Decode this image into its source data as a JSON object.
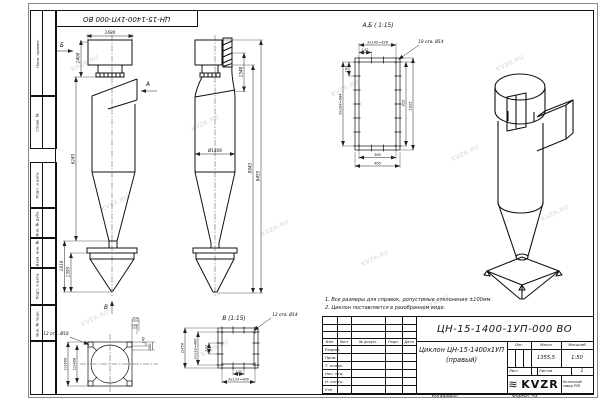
{
  "sheet": {
    "stamp_top": "ЦН-15-1400-1УП-000 ВО",
    "watermark": "KVZR.RU"
  },
  "margin": {
    "labels": [
      "Перв. примен.",
      "Справ. №",
      "Подп. и дата",
      "Инв. № дубл.",
      "Взам. инв. №",
      "Подп. и дата",
      "Инв. № подл."
    ]
  },
  "notes": {
    "line1": "1. Все размеры для справок, допустимые отклонения ±100мм.",
    "line2": "2. Циклон поставляется в разобранном виде."
  },
  "front_view": {
    "dim_top": "1680",
    "dim_height_outlet": "1400",
    "dim_body": "6245",
    "dim_bunker": "1810",
    "dim_bunker_cone": "1395",
    "arrow_a": "А",
    "arrow_b": "Б"
  },
  "side_view": {
    "dim_flange": "1548",
    "dim_diameter": "Ø1408",
    "dim_h1": "8943",
    "dim_h2": "9455"
  },
  "section_ab": {
    "title": "А,Б ( 1:15)",
    "holes_note": "18 отв. Ø14",
    "dim_chain_top": "3х142=426",
    "dim_142": "142",
    "dim_164": "164",
    "dim_chain_left": "6х164=984",
    "dim_925": "925",
    "dim_1025": "1025",
    "dim_365": "365",
    "dim_465": "465"
  },
  "view_v": {
    "title": "В (1:15)",
    "holes_note": "12 отв. Ø14",
    "dim_square": "□450",
    "dim_chain_left": "3х133=400",
    "dim_133_v": "133",
    "dim_133_h": "133",
    "dim_chain_bottom": "3х133=400"
  },
  "bottom_view": {
    "label": "В",
    "holes_note": "12 отв. Ø18",
    "dim_outer": "□1606",
    "dim_inner": "□1408",
    "dim_200": "200",
    "dim_140": "140",
    "dim_145": "145",
    "dim_300": "300"
  },
  "title_block": {
    "doc_number": "ЦН-15-1400-1УП-000 ВО",
    "title_line1": "Циклон ЦН-15-1400х1УП",
    "title_line2": "(правый)",
    "col_izm": "Изм.",
    "col_list": "Лист",
    "col_doc": "№ докум.",
    "col_podp": "Подп.",
    "col_data": "Дата",
    "rows": [
      "Разраб.",
      "Пров.",
      "Т. контр.",
      "Нач. отд.",
      "Н. контр.",
      "Утв."
    ],
    "lit_label": "Лит.",
    "mass_label": "Масса",
    "scale_label": "Масштаб",
    "mass_value": "1355,5",
    "scale_value": "1:50",
    "sheet_label": "Лист",
    "sheets_label": "Листов",
    "sheets_value": "1",
    "logo_text": "KVZR",
    "company_line1": "Котельный",
    "company_line2": "завод РЭП",
    "copied_label": "Копировал",
    "format_label": "Формат А3"
  }
}
